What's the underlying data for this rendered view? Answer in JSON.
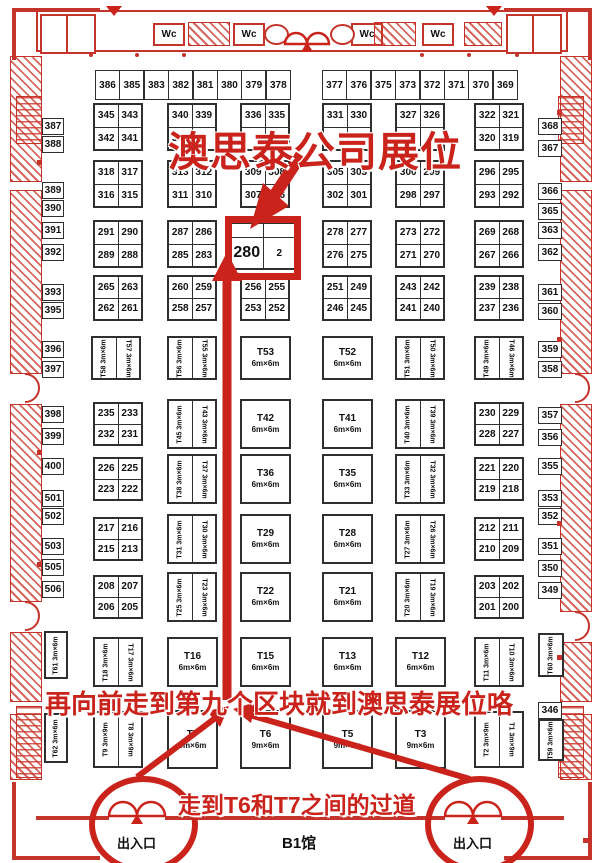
{
  "hall": {
    "label": "B1馆",
    "wc_label": "Wc",
    "entrance_label": "出入口",
    "red": "#c9231c"
  },
  "annotations": {
    "title": "澳思泰公司展位",
    "mid_note": "再向前走到第九个区块就到澳思泰展位咯",
    "bottom_note": "走到T6和T7之间的过道",
    "highlight_booth": "280"
  },
  "top_row": {
    "y": 70,
    "h": 28,
    "w": 23,
    "groups": [
      {
        "x": 95,
        "labels": [
          "386",
          "385",
          "383",
          "382",
          "381",
          "380",
          "379",
          "378"
        ]
      },
      {
        "x": 322,
        "labels": [
          "377",
          "376",
          "375",
          "373",
          "372",
          "371",
          "370",
          "369"
        ]
      }
    ]
  },
  "side_booths": {
    "left": [
      {
        "t": "387",
        "y": 118
      },
      {
        "t": "388",
        "y": 136
      },
      {
        "t": "389",
        "y": 182
      },
      {
        "t": "390",
        "y": 200
      },
      {
        "t": "391",
        "y": 222
      },
      {
        "t": "392",
        "y": 244
      },
      {
        "t": "393",
        "y": 284
      },
      {
        "t": "395",
        "y": 302
      },
      {
        "t": "396",
        "y": 341
      },
      {
        "t": "397",
        "y": 361
      },
      {
        "t": "398",
        "y": 406
      },
      {
        "t": "399",
        "y": 428
      },
      {
        "t": "400",
        "y": 458
      },
      {
        "t": "501",
        "y": 490
      },
      {
        "t": "502",
        "y": 508
      },
      {
        "t": "503",
        "y": 538
      },
      {
        "t": "505",
        "y": 559
      },
      {
        "t": "506",
        "y": 581
      }
    ],
    "right": [
      {
        "t": "368",
        "y": 118
      },
      {
        "t": "367",
        "y": 140
      },
      {
        "t": "366",
        "y": 183
      },
      {
        "t": "365",
        "y": 203
      },
      {
        "t": "363",
        "y": 222
      },
      {
        "t": "362",
        "y": 244
      },
      {
        "t": "361",
        "y": 284
      },
      {
        "t": "360",
        "y": 303
      },
      {
        "t": "359",
        "y": 341
      },
      {
        "t": "358",
        "y": 361
      },
      {
        "t": "357",
        "y": 407
      },
      {
        "t": "356",
        "y": 429
      },
      {
        "t": "355",
        "y": 458
      },
      {
        "t": "353",
        "y": 490
      },
      {
        "t": "352",
        "y": 508
      },
      {
        "t": "351",
        "y": 538
      },
      {
        "t": "350",
        "y": 560
      },
      {
        "t": "349",
        "y": 582
      },
      {
        "t": "346",
        "y": 702
      }
    ]
  },
  "number_blocks": [
    {
      "x": 93,
      "y": 103,
      "cells": [
        "345",
        "343",
        "342",
        "341"
      ]
    },
    {
      "x": 167,
      "y": 103,
      "cells": [
        "340",
        "339",
        "338",
        ""
      ]
    },
    {
      "x": 240,
      "y": 103,
      "cells": [
        "336",
        "335",
        "",
        ""
      ]
    },
    {
      "x": 322,
      "y": 103,
      "cells": [
        "331",
        "330",
        "",
        ""
      ]
    },
    {
      "x": 395,
      "y": 103,
      "cells": [
        "327",
        "326",
        "",
        ""
      ]
    },
    {
      "x": 474,
      "y": 103,
      "cells": [
        "322",
        "321",
        "320",
        "319"
      ]
    },
    {
      "x": 93,
      "y": 160,
      "cells": [
        "318",
        "317",
        "316",
        "315"
      ]
    },
    {
      "x": 167,
      "y": 160,
      "cells": [
        "313",
        "312",
        "311",
        "310"
      ]
    },
    {
      "x": 240,
      "y": 160,
      "cells": [
        "309",
        "308",
        "307",
        "306"
      ]
    },
    {
      "x": 322,
      "y": 160,
      "cells": [
        "305",
        "303",
        "302",
        "301"
      ]
    },
    {
      "x": 395,
      "y": 160,
      "cells": [
        "300",
        "299",
        "298",
        "297"
      ]
    },
    {
      "x": 474,
      "y": 160,
      "cells": [
        "296",
        "295",
        "293",
        "292"
      ]
    },
    {
      "x": 93,
      "y": 220,
      "cells": [
        "291",
        "290",
        "289",
        "288"
      ]
    },
    {
      "x": 167,
      "y": 220,
      "cells": [
        "287",
        "286",
        "285",
        "283"
      ]
    },
    {
      "x": 322,
      "y": 220,
      "cells": [
        "278",
        "277",
        "276",
        "275"
      ]
    },
    {
      "x": 395,
      "y": 220,
      "cells": [
        "273",
        "272",
        "271",
        "270"
      ]
    },
    {
      "x": 474,
      "y": 220,
      "cells": [
        "269",
        "268",
        "267",
        "266"
      ]
    },
    {
      "x": 93,
      "y": 275,
      "h": 42,
      "cells": [
        "265",
        "263",
        "262",
        "261"
      ]
    },
    {
      "x": 167,
      "y": 275,
      "h": 42,
      "cells": [
        "260",
        "259",
        "258",
        "257"
      ]
    },
    {
      "x": 240,
      "y": 275,
      "h": 42,
      "cells": [
        "256",
        "255",
        "253",
        "252"
      ]
    },
    {
      "x": 322,
      "y": 275,
      "h": 42,
      "cells": [
        "251",
        "249",
        "246",
        "245"
      ]
    },
    {
      "x": 395,
      "y": 275,
      "h": 42,
      "cells": [
        "243",
        "242",
        "241",
        "240"
      ]
    },
    {
      "x": 474,
      "y": 275,
      "h": 42,
      "cells": [
        "239",
        "238",
        "237",
        "236"
      ]
    },
    {
      "x": 93,
      "y": 402,
      "h": 40,
      "cells": [
        "235",
        "233",
        "232",
        "231"
      ]
    },
    {
      "x": 474,
      "y": 402,
      "h": 40,
      "cells": [
        "230",
        "229",
        "228",
        "227"
      ]
    },
    {
      "x": 93,
      "y": 457,
      "h": 40,
      "cells": [
        "226",
        "225",
        "223",
        "222"
      ]
    },
    {
      "x": 474,
      "y": 457,
      "h": 40,
      "cells": [
        "221",
        "220",
        "219",
        "218"
      ]
    },
    {
      "x": 93,
      "y": 517,
      "h": 40,
      "cells": [
        "217",
        "216",
        "215",
        "213"
      ]
    },
    {
      "x": 474,
      "y": 517,
      "h": 40,
      "cells": [
        "212",
        "211",
        "210",
        "209"
      ]
    },
    {
      "x": 93,
      "y": 575,
      "h": 40,
      "cells": [
        "208",
        "207",
        "206",
        "205"
      ]
    },
    {
      "x": 474,
      "y": 575,
      "h": 40,
      "cells": [
        "203",
        "202",
        "201",
        "200"
      ]
    }
  ],
  "center_block": {
    "x": 229,
    "y": 222,
    "w": 64,
    "h": 44,
    "cells": [
      "",
      "",
      "280",
      "2"
    ]
  },
  "t_pairs": [
    {
      "x": 91,
      "y": 336,
      "h": 40,
      "ids": [
        "T58",
        "T57"
      ],
      "dim": "3m×6m"
    },
    {
      "x": 167,
      "y": 336,
      "h": 40,
      "ids": [
        "T56",
        "T55"
      ],
      "dim": "3m×6m"
    },
    {
      "x": 395,
      "y": 336,
      "h": 40,
      "ids": [
        "T51",
        "T50"
      ],
      "dim": "3m×6m"
    },
    {
      "x": 474,
      "y": 336,
      "h": 40,
      "ids": [
        "T49",
        "T46"
      ],
      "dim": "3m×6m"
    },
    {
      "x": 167,
      "y": 399,
      "h": 46,
      "ids": [
        "T45",
        "T43"
      ],
      "dim": "3m×6m"
    },
    {
      "x": 395,
      "y": 399,
      "h": 46,
      "ids": [
        "T40",
        "T39"
      ],
      "dim": "3m×6m"
    },
    {
      "x": 167,
      "y": 454,
      "h": 46,
      "ids": [
        "T38",
        "T37"
      ],
      "dim": "3m×6m"
    },
    {
      "x": 395,
      "y": 454,
      "h": 46,
      "ids": [
        "T33",
        "T32"
      ],
      "dim": "3m×6m"
    },
    {
      "x": 167,
      "y": 514,
      "h": 46,
      "ids": [
        "T31",
        "T30"
      ],
      "dim": "3m×6m"
    },
    {
      "x": 395,
      "y": 514,
      "h": 46,
      "ids": [
        "T27",
        "T26"
      ],
      "dim": "3m×6m"
    },
    {
      "x": 167,
      "y": 572,
      "h": 46,
      "ids": [
        "T25",
        "T23"
      ],
      "dim": "3m×6m"
    },
    {
      "x": 395,
      "y": 572,
      "h": 46,
      "ids": [
        "T20",
        "T19"
      ],
      "dim": "3m×6m"
    },
    {
      "x": 93,
      "y": 637,
      "h": 46,
      "ids": [
        "T18",
        "T17"
      ],
      "dim": "3m×6m"
    },
    {
      "x": 474,
      "y": 637,
      "h": 46,
      "ids": [
        "T11",
        "T10"
      ],
      "dim": "3m×6m"
    },
    {
      "x": 93,
      "y": 711,
      "h": 53,
      "ids": [
        "T9",
        "T8"
      ],
      "dim": "3m×9m"
    },
    {
      "x": 474,
      "y": 711,
      "h": 53,
      "ids": [
        "T2",
        "T1"
      ],
      "dim": "3m×9m"
    }
  ],
  "t_bigs": [
    {
      "x": 240,
      "y": 336,
      "h": 40,
      "id": "T53",
      "dim": "6m×6m"
    },
    {
      "x": 322,
      "y": 336,
      "h": 40,
      "id": "T52",
      "dim": "6m×6m"
    },
    {
      "x": 240,
      "y": 399,
      "h": 46,
      "id": "T42",
      "dim": "6m×6m"
    },
    {
      "x": 322,
      "y": 399,
      "h": 46,
      "id": "T41",
      "dim": "6m×6m"
    },
    {
      "x": 240,
      "y": 454,
      "h": 46,
      "id": "T36",
      "dim": "6m×6m"
    },
    {
      "x": 322,
      "y": 454,
      "h": 46,
      "id": "T35",
      "dim": "6m×6m"
    },
    {
      "x": 240,
      "y": 514,
      "h": 46,
      "id": "T29",
      "dim": "6m×6m"
    },
    {
      "x": 322,
      "y": 514,
      "h": 46,
      "id": "T28",
      "dim": "6m×6m"
    },
    {
      "x": 240,
      "y": 572,
      "h": 46,
      "id": "T22",
      "dim": "6m×6m"
    },
    {
      "x": 322,
      "y": 572,
      "h": 46,
      "id": "T21",
      "dim": "6m×6m"
    },
    {
      "x": 167,
      "y": 637,
      "h": 46,
      "id": "T16",
      "dim": "6m×6m"
    },
    {
      "x": 240,
      "y": 637,
      "h": 46,
      "id": "T15",
      "dim": "6m×6m"
    },
    {
      "x": 322,
      "y": 637,
      "h": 46,
      "id": "T13",
      "dim": "6m×6m"
    },
    {
      "x": 395,
      "y": 637,
      "h": 46,
      "id": "T12",
      "dim": "6m×6m"
    },
    {
      "x": 167,
      "y": 710,
      "h": 55,
      "id": "T7",
      "dim": "9m×6m"
    },
    {
      "x": 240,
      "y": 710,
      "h": 55,
      "id": "T6",
      "dim": "9m×6m"
    },
    {
      "x": 322,
      "y": 710,
      "h": 55,
      "id": "T5",
      "dim": "9m×6m"
    },
    {
      "x": 395,
      "y": 710,
      "h": 55,
      "id": "T3",
      "dim": "9m×6m"
    }
  ],
  "t_singles": [
    {
      "x": 44,
      "y": 631,
      "w": 20,
      "h": 44,
      "id": "T61",
      "dim": "3m×6m"
    },
    {
      "x": 44,
      "y": 713,
      "w": 20,
      "h": 46,
      "id": "T62",
      "dim": "3m×6m"
    },
    {
      "x": 538,
      "y": 633,
      "w": 22,
      "h": 40,
      "id": "T60",
      "dim": "3m×6m"
    },
    {
      "x": 538,
      "y": 719,
      "w": 22,
      "h": 38,
      "id": "T59",
      "dim": "3m×6m"
    }
  ],
  "entrances": [
    {
      "cx": 137
    },
    {
      "cx": 473
    }
  ]
}
